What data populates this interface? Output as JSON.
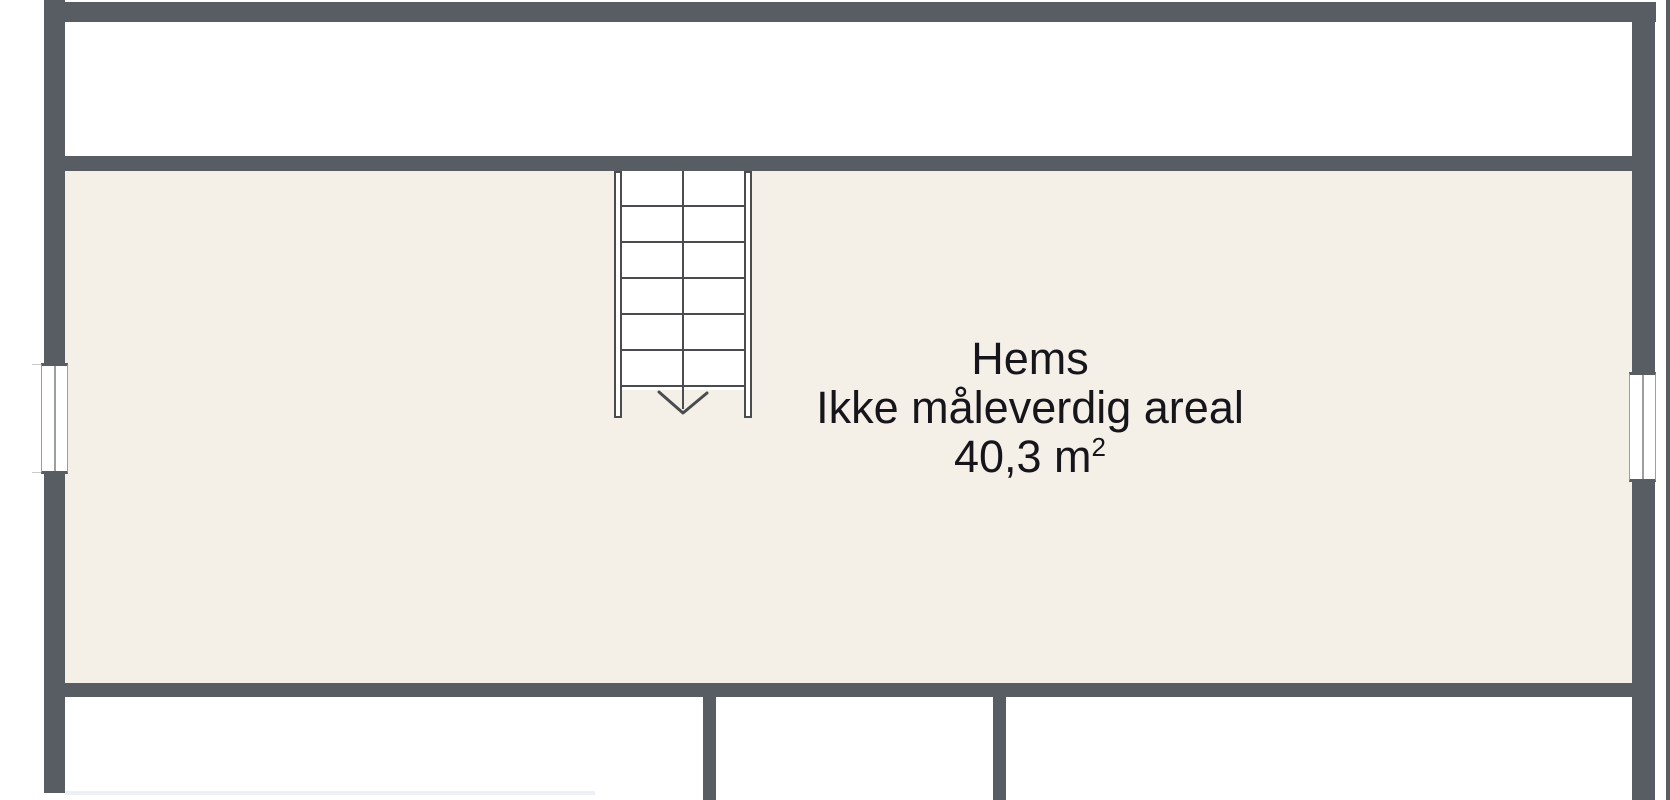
{
  "colors": {
    "wall": "#585c63",
    "line": "#4a4c50",
    "floor": "#f5f0e7",
    "canvas": "#ffffff",
    "text": "#15151b",
    "frame": "#9b9ea3",
    "faint": "#edf0f4"
  },
  "label": {
    "room_name": "Hems",
    "room_note": "Ikke måleverdig areal",
    "area_value": "40,3 m",
    "area_superscript": "2"
  },
  "stairs": {
    "direction": "down"
  }
}
